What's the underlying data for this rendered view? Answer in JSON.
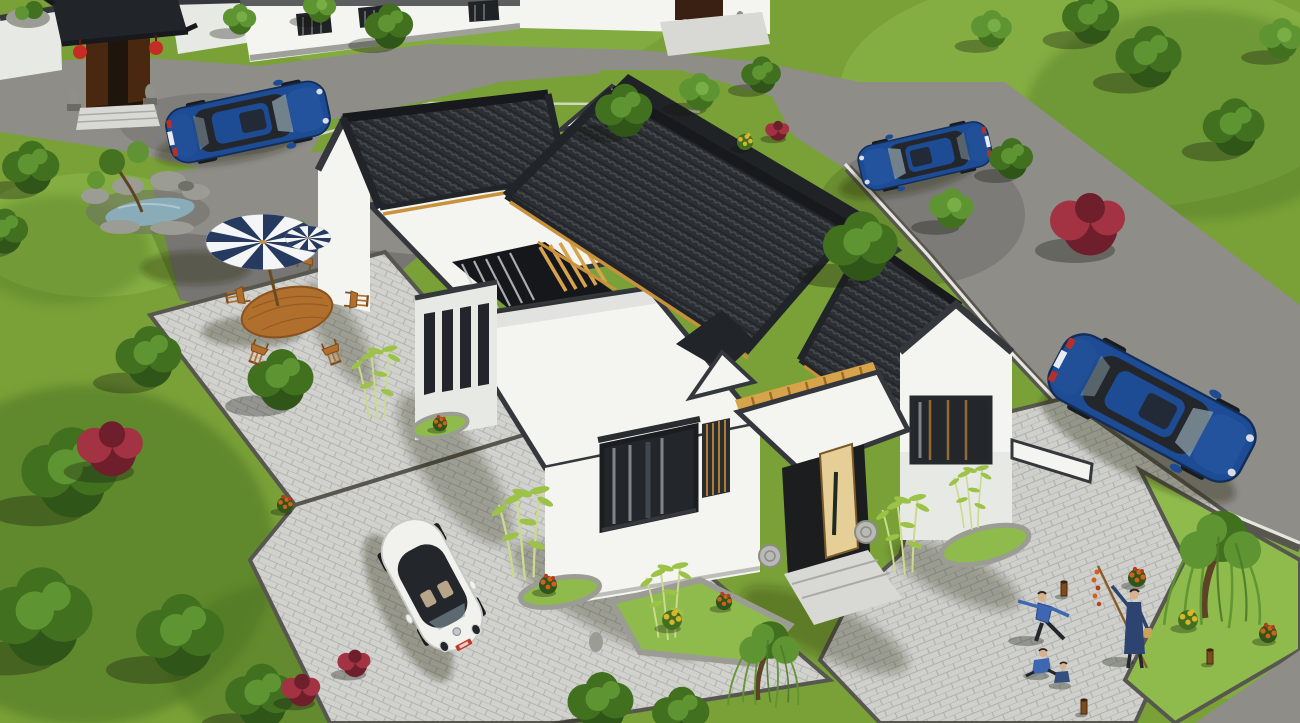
{
  "scene": {
    "title": "Aerial 3D rendering of a Chinese-style single-storey white courtyard residence with dark tiled roofs",
    "view": "high-angle aerial perspective, daytime",
    "setting": "residential neighborhood with lawns, asphalt roads, paver courtyards and mature trees"
  },
  "palette": {
    "grass": "#79a138",
    "grassLight": "#8fbb4c",
    "grassDark": "#4a7021",
    "road": "#8e8d88",
    "roadShade": "#6f6e6a",
    "kerb": "#57564f",
    "curb": "#e6e6df",
    "paver": "#d1d2ce",
    "paverLine": "#b2b3af",
    "wall": "#f4f5f1",
    "wallShade": "#e7e9e4",
    "coping": "#34373b",
    "tile": "#2c2f33",
    "tileRow": "#4a5056",
    "tileDark": "#212428",
    "ridge": "#17191c",
    "trim": "#c8913b",
    "beam": "#d7a34b",
    "door": "#e6cf97",
    "doorEdge": "#7a5a2a",
    "glass": "#23272c",
    "glassHi": "#8ea1ac",
    "slat": "#b07b36",
    "carBlue": "#1d4b94",
    "carBlueHi": "#3567b4",
    "carBlueDark": "#122d58",
    "carWhite": "#f1f2ee",
    "wheel": "#191b1d",
    "plateRed": "#c03a2e",
    "plateWhite": "#e8ecf2",
    "umbBlue": "#26395e",
    "umbWhite": "#f3f5f7",
    "wood": "#b06f2c",
    "woodDark": "#7c4b1b",
    "water": "#8aabb8",
    "rock": "#9b9c93",
    "rockShade": "#6f7068",
    "treeDark": "#2f5519",
    "treeMid": "#41701f",
    "treeLight": "#5f9432",
    "bushRed": "#6f1f2c",
    "bushRedHi": "#a33342",
    "flowerOrange": "#d2601c",
    "flowerYellow": "#d9b52c",
    "bambooLeaf": "#9cc247",
    "bambooStalk": "#cadb8e",
    "skin": "#d9b18c",
    "clothBlue": "#3f66b0",
    "clothDark": "#2e4470",
    "lantern": "#c62b25",
    "gateDoor": "#49280f",
    "lion": "#8f9089",
    "step": "#d8d9d4",
    "shadow": "rgba(18,22,12,0.32)"
  },
  "buildings": {
    "main_house": {
      "label": "main courtyard house",
      "walls": "white rendered walls",
      "roof": "charcoal Chinese tile gable roofs with white flat-roof sections",
      "trim": "golden timber eave trim and pergola beams",
      "features": [
        "inner courtyard with timber pergola",
        "lattice windows",
        "open light-timber entrance door",
        "stone drums flanking entrance",
        "entrance steps"
      ]
    },
    "neighbor_gate": {
      "label": "traditional entrance gate of neighboring compound",
      "features": [
        "grey tile gate roof",
        "two red lanterns",
        "two stone lions",
        "dark timber doors"
      ]
    },
    "neighbor_houses": {
      "label": "white-walled neighbor houses along top street",
      "count": 3
    }
  },
  "vehicles": [
    {
      "label": "white beetle-style car",
      "color": "white",
      "location": "front paver driveway",
      "plate": "red"
    },
    {
      "label": "blue sedan",
      "color": "dark blue",
      "location": "road on the right",
      "plate": "white"
    },
    {
      "label": "blue sedan",
      "color": "dark blue",
      "location": "top road beside trees"
    },
    {
      "label": "blue sedan",
      "color": "dark blue",
      "location": "in front of neighbor gate, top left"
    }
  ],
  "landscape": {
    "features": [
      "rock-edged garden pond",
      "lawns",
      "weeping willows",
      "bamboo clumps",
      "stone-edged flower beds",
      "herringbone paver courtyards",
      "asphalt roads with stone kerbs"
    ],
    "flower_colors": [
      "orange",
      "yellow",
      "red",
      "burgundy"
    ]
  },
  "furniture": {
    "patio_umbrella": {
      "label": "striped patio umbrella",
      "colors": [
        "navy",
        "white"
      ]
    },
    "dining_set": {
      "table": "oval timber garden table",
      "chairs": 5
    }
  },
  "people": [
    {
      "label": "elder practicing tai-chi",
      "clothing": "blue"
    },
    {
      "label": "man holding long pole with orange blossoms",
      "clothing": "dark blue"
    },
    {
      "label": "child sitting on plaza",
      "clothing": "blue"
    },
    {
      "label": "child sitting on plaza",
      "clothing": "dark blue"
    }
  ]
}
